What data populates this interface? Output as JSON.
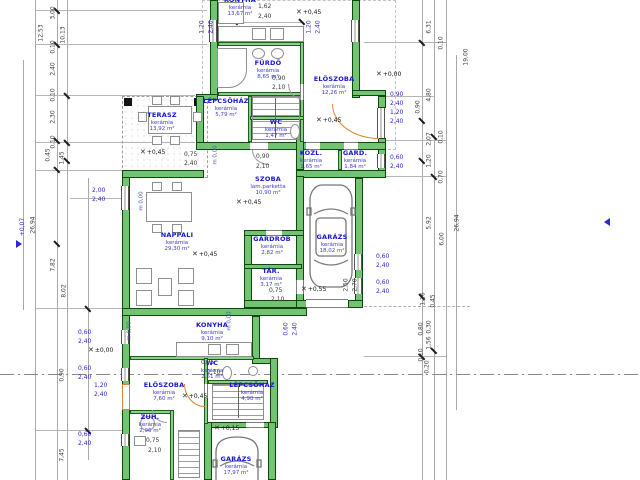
{
  "palette": {
    "wall_green": "#72c472",
    "label_blue": "#1717cf",
    "dim_blue": "#2a2ace",
    "door_orange": "#e08030"
  },
  "rooms": [
    {
      "name": "KONYHA",
      "material": "kerámia",
      "area": "13,67 m²"
    },
    {
      "name": "FÜRDŐ",
      "material": "kerámia",
      "area": "8,65 m²"
    },
    {
      "name": "ELŐSZOBA",
      "material": "kerámia",
      "area": "12,26 m²"
    },
    {
      "name": "LÉPCSŐHÁZ",
      "material": "kerámia",
      "area": "5,79 m²"
    },
    {
      "name": "WC",
      "material": "kerámia",
      "area": "1,47 m²"
    },
    {
      "name": "TERASZ",
      "material": "kerámia",
      "area": "13,92 m²"
    },
    {
      "name": "KÖZL.",
      "material": "kerámia",
      "area": "1,65 m²"
    },
    {
      "name": "GARD.",
      "material": "kerámia",
      "area": "1,84 m²"
    },
    {
      "name": "SZOBA",
      "material": "lam.parketta",
      "area": "10,90 m²"
    },
    {
      "name": "NAPPALI",
      "material": "kerámia",
      "area": "29,30 m²"
    },
    {
      "name": "GARDRÓB",
      "material": "kerámia",
      "area": "2,82 m²"
    },
    {
      "name": "TÁR.",
      "material": "kerámia",
      "area": "3,17 m²"
    },
    {
      "name": "GARÁZS",
      "material": "kerámia",
      "area": "18,02 m²"
    },
    {
      "name": "KONYHA",
      "material": "kerámia",
      "area": "9,10 m²"
    },
    {
      "name": "WC",
      "material": "kerámia",
      "area": "2,51 m²"
    },
    {
      "name": "ELŐSZOBA",
      "material": "kerámia",
      "area": "7,60 m²"
    },
    {
      "name": "LÉPCSŐHÁZ",
      "material": "kerámia",
      "area": "4,90 m²"
    },
    {
      "name": "ZUH.",
      "material": "kerámia",
      "area": "2,96 m²"
    },
    {
      "name": "GARÁZS",
      "material": "kerámia",
      "area": "17,97 m²"
    }
  ],
  "elevations": [
    "+0,45",
    "+0,00",
    "+0,45",
    "+0,45",
    "+0,45",
    "+0,45",
    "+0,55",
    "±0,00",
    "+0,45",
    "+0,15"
  ],
  "levels": {
    "left_total": "26,94",
    "right_total": "26,94",
    "left_mark": "+0,07"
  },
  "notes": {
    "parapet": "m 0,00"
  },
  "dims": {
    "left": [
      "3,00",
      "12,53",
      "10,13",
      "0,10",
      "2,40",
      "0,10",
      "2,30",
      "0,10",
      "0,45",
      "1,45",
      "7,82",
      "8,02",
      "0,90",
      "7,45"
    ],
    "right": [
      "6,31",
      "0,10",
      "19,00",
      "4,80",
      "0,90",
      "2,07",
      "0,10",
      "1,20",
      "0,70",
      "5,92",
      "6,00",
      "1,16",
      "0,45",
      "0,80",
      "0,30",
      "1,56",
      "0,10",
      "0,20"
    ],
    "top": [
      "1,62",
      "2,40"
    ],
    "inner": [
      "0,75",
      "2,40",
      "0,90",
      "2,10",
      "0,90",
      "2,10",
      "0,75",
      "2,10",
      "0,75",
      "2,10",
      "0,75",
      "2,10",
      "2,50",
      "2,70"
    ],
    "windows": [
      "2,00",
      "2,40",
      "0,60",
      "2,40",
      "0,60",
      "2,40",
      "1,20",
      "2,40",
      "0,60",
      "2,40",
      "0,90",
      "2,40",
      "1,20",
      "2,40",
      "0,60",
      "2,40",
      "0,60",
      "2,40",
      "0,60",
      "2,40",
      "1,20",
      "2,40",
      "1,20",
      "2,40",
      "0,60",
      "2,40"
    ]
  }
}
